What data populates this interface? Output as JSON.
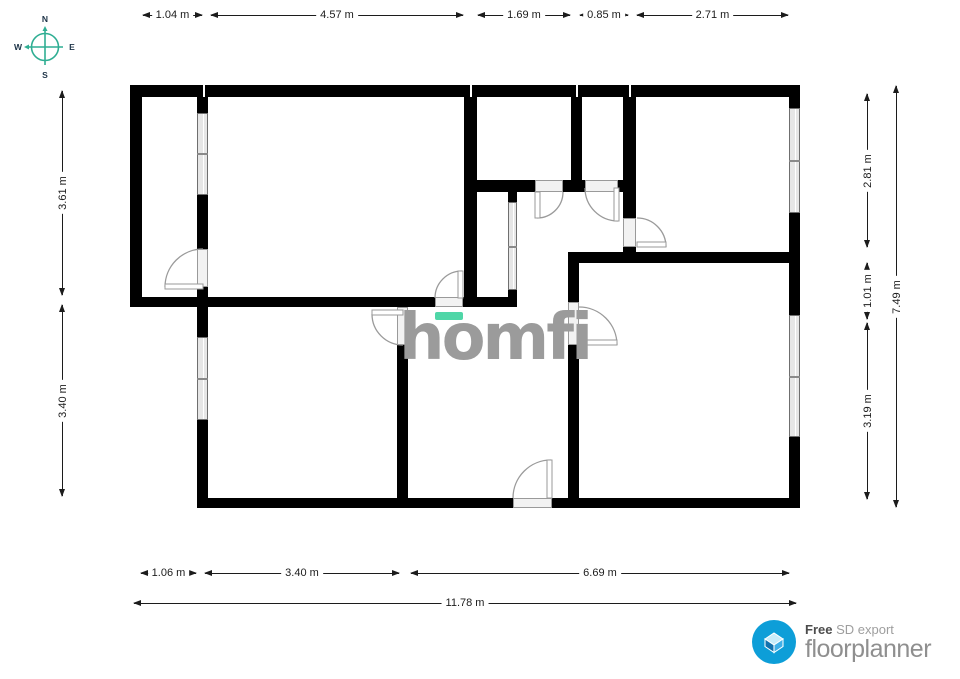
{
  "compass": {
    "north": "N",
    "east": "E",
    "south": "S",
    "west": "W"
  },
  "watermark": {
    "text": "homfi"
  },
  "footer_logo": {
    "free_label": "Free",
    "export_label": "SD export",
    "brand": "floorplanner"
  },
  "dimensions": {
    "top": [
      {
        "label": "1.04 m"
      },
      {
        "label": "4.57 m"
      },
      {
        "label": "1.69 m"
      },
      {
        "label": "0.85 m"
      },
      {
        "label": "2.71 m"
      }
    ],
    "bottom": [
      {
        "label": "1.06 m"
      },
      {
        "label": "3.40 m"
      },
      {
        "label": "6.69 m"
      }
    ],
    "bottom_total": {
      "label": "11.78 m"
    },
    "left": [
      {
        "label": "3.61 m"
      },
      {
        "label": "3.40 m"
      }
    ],
    "right": [
      {
        "label": "2.81 m"
      },
      {
        "label": "1.01 m"
      },
      {
        "label": "3.19 m"
      }
    ],
    "right_total": {
      "label": "7.49 m"
    }
  },
  "colors": {
    "wall": "#000000",
    "accent_teal": "#4fd6a7",
    "compass_teal": "#2fae93",
    "watermark_gray": "#9b9b9b",
    "brand_blue": "#0d9ed8"
  }
}
